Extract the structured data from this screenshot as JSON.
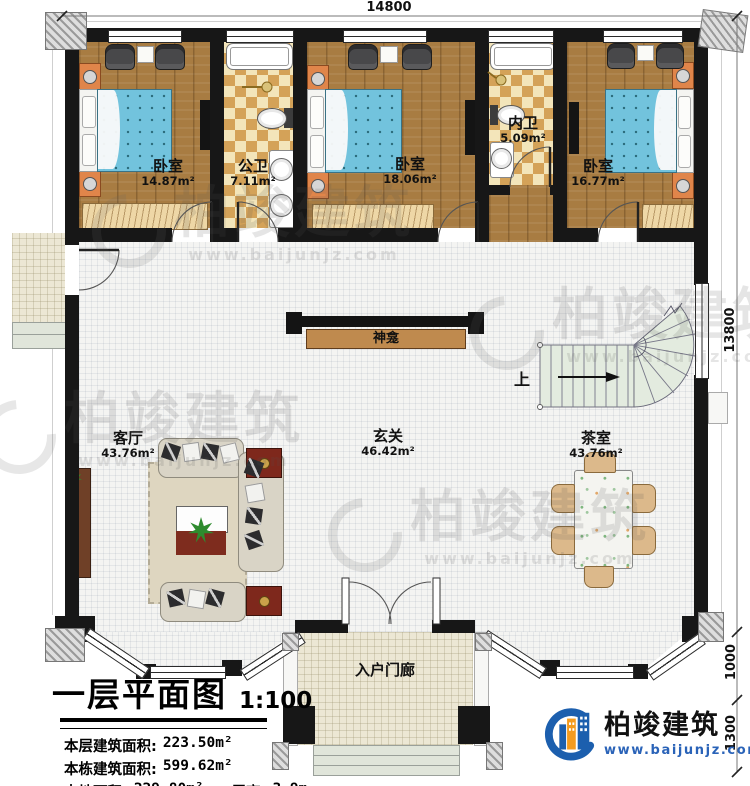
{
  "plan": {
    "rooms": {
      "bedroom1": {
        "name": "卧室",
        "area": "14.87m²"
      },
      "public_bath": {
        "name": "公卫",
        "area": "7.11m²"
      },
      "bedroom2": {
        "name": "卧室",
        "area": "18.06m²"
      },
      "inner_bath": {
        "name": "内卫",
        "area": "5.09m²"
      },
      "bedroom3": {
        "name": "卧室",
        "area": "16.77m²"
      },
      "living_room": {
        "name": "客厅",
        "area": "43.76m²"
      },
      "foyer": {
        "name": "玄关",
        "area": "46.42m²"
      },
      "tea_room": {
        "name": "茶室",
        "area": "43.76m²"
      },
      "entry_porch": {
        "name": "入户门廊"
      },
      "shrine": {
        "name": "神龛"
      },
      "stair_up": {
        "label": "上"
      }
    },
    "dimensions": {
      "top": "14800",
      "right_total": "13800",
      "right_porch": "1000",
      "right_steps": "1300"
    }
  },
  "title_block": {
    "title": "一层平面图",
    "scale": "1:100",
    "stats": [
      {
        "label": "本层建筑面积:",
        "value": "223.50m²"
      },
      {
        "label": "本栋建筑面积:",
        "value": "599.62m²"
      },
      {
        "label": "占地面积:",
        "value": "229.80m²"
      },
      {
        "label": "层高:",
        "value": "3.9m"
      }
    ]
  },
  "branding": {
    "company": "柏竣建筑",
    "website": "www.baijunjz.com"
  },
  "watermark": {
    "text": "柏竣建筑",
    "url": "www.baijunjz.com"
  },
  "colors": {
    "accent_blue": "#1c5fae",
    "accent_orange": "#f49b1f",
    "wall": "#171717",
    "bed": "#72c3dd"
  }
}
